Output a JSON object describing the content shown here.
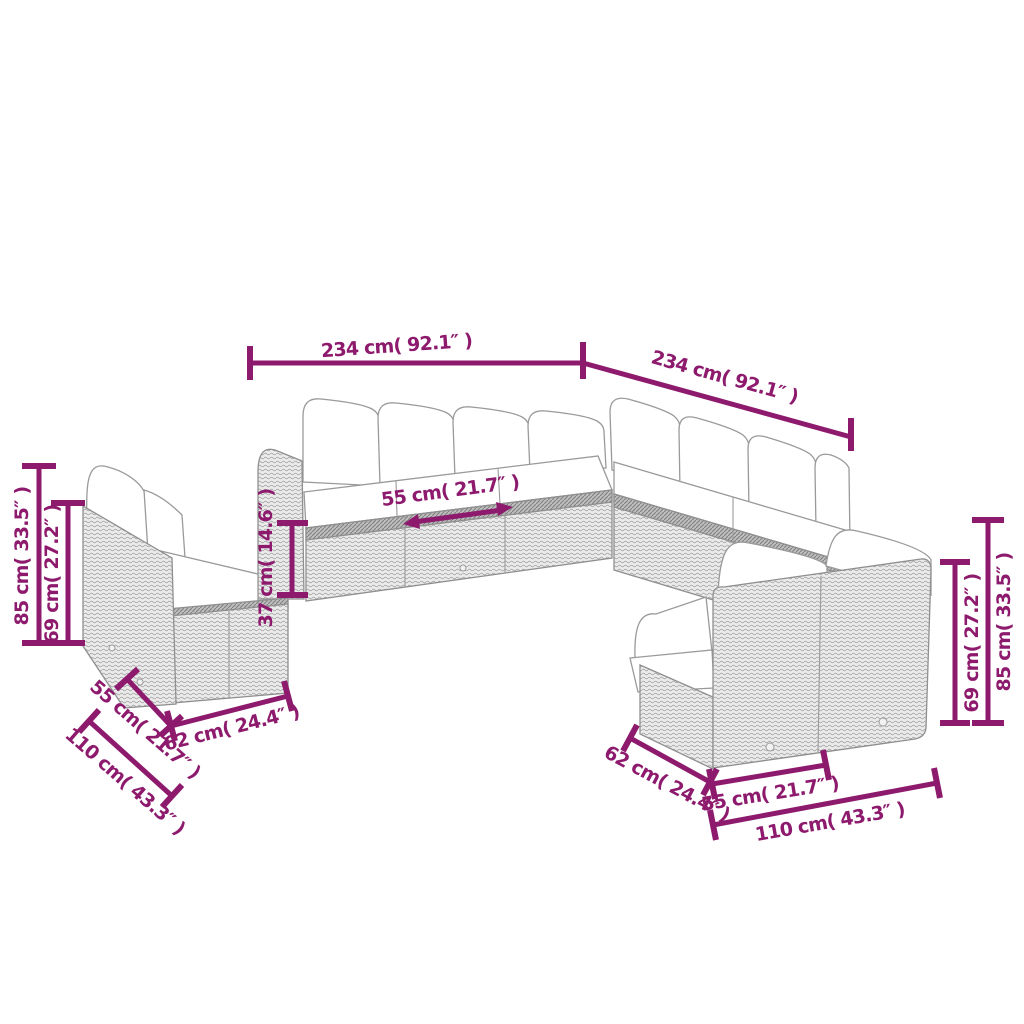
{
  "background_color": "#ffffff",
  "dimension_color": "#8d1a6d",
  "furniture_style": {
    "weave_base_color": "#ebebeb",
    "weave_line_color": "#a6a6a6",
    "rail_color": "#bdbdbd",
    "outline_color": "#8f8f8f",
    "cushion_color": "#ffffff"
  },
  "dimensions": {
    "top_width": "234 cm( 92.1″ )",
    "top_depth": "234 cm( 92.1″ )",
    "left_total_height": "85 cm( 33.5″ )",
    "left_back_height": "69 cm( 27.2″ )",
    "seat_height": "37 cm( 14.6″ )",
    "seat_width": "55 cm( 21.7″ )",
    "left_seat_width": "55 cm( 21.7″ )",
    "left_depth": "110 cm( 43.3″ )",
    "left_base_depth": "62 cm( 24.4″ )",
    "right_base_depth": "62 cm( 24.4″ )",
    "right_seat_width": "55 cm( 21.7″ )",
    "right_depth": "110 cm( 43.3″ )",
    "right_back_height": "69 cm( 27.2″ )",
    "right_total_height": "85 cm( 33.5″ )"
  }
}
